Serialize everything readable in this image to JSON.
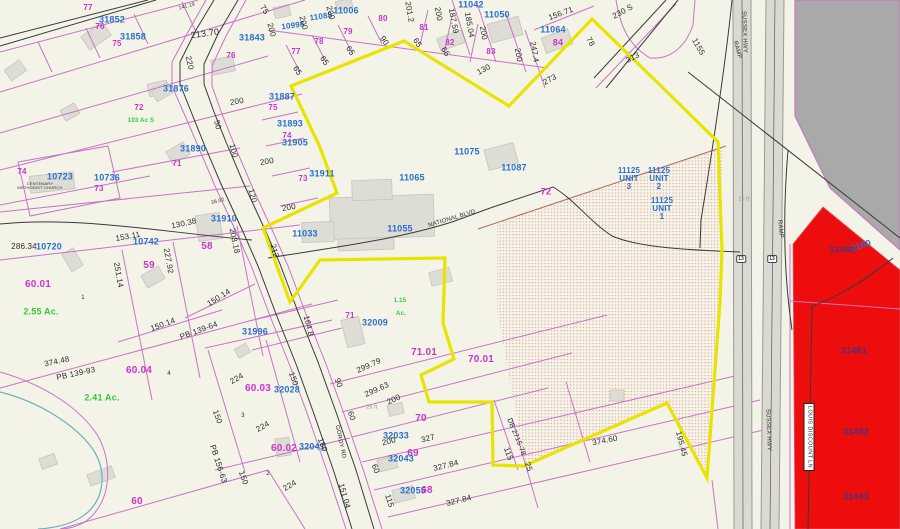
{
  "map_type": "county-tax-parcel-map",
  "colors": {
    "background": "#f4f3e8",
    "parcel_line": "#c873c8",
    "highlight_boundary": "#e8e400",
    "red_parcel": "#ee0d0d",
    "gray_area": "#a9a9a9",
    "road_fill": "#dbdad2",
    "parcel_id_text": "#2a6fcc",
    "lot_number_text": "#cc33cc",
    "acreage_text": "#2ecc3a",
    "dimension_text": "#2b2b2b",
    "stream": "#68b0ba",
    "stipple_dot": "#dd8a80"
  },
  "roads": {
    "national_blvd": "NATIONAL BLVD",
    "gordy_rd": "GORDY RD",
    "sussex_hwy": "SUSSEX HWY",
    "ramp": "RAMP",
    "louis_discount_ln": "LOUIS DISCOUNT LN",
    "road_230s": "230 S",
    "route_shield": "13"
  },
  "labels": [
    {
      "t": "77",
      "x": 88,
      "y": 8,
      "c": "m"
    },
    {
      "t": "31852",
      "x": 112,
      "y": 20,
      "c": "b",
      "s": 9
    },
    {
      "t": "76",
      "x": 100,
      "y": 27,
      "c": "m"
    },
    {
      "t": "31858",
      "x": 133,
      "y": 37,
      "c": "b",
      "s": 9
    },
    {
      "t": "75",
      "x": 117,
      "y": 44,
      "c": "m"
    },
    {
      "t": "141.19",
      "x": 187,
      "y": 7,
      "s": 5,
      "r": -15
    },
    {
      "t": "213.70",
      "x": 205,
      "y": 34,
      "r": -8,
      "s": 9
    },
    {
      "t": "31843",
      "x": 252,
      "y": 38,
      "c": "b",
      "s": 9
    },
    {
      "t": "76",
      "x": 231,
      "y": 56,
      "c": "m"
    },
    {
      "t": "220",
      "x": 189,
      "y": 63,
      "r": 78
    },
    {
      "t": "75",
      "x": 264,
      "y": 10,
      "r": 55
    },
    {
      "t": "200",
      "x": 271,
      "y": 30,
      "r": 75
    },
    {
      "t": "10998",
      "x": 293,
      "y": 26,
      "c": "b",
      "r": -8
    },
    {
      "t": "11088",
      "x": 321,
      "y": 17,
      "c": "b",
      "r": -8
    },
    {
      "t": "11006",
      "x": 346,
      "y": 11,
      "c": "b",
      "s": 9
    },
    {
      "t": "200",
      "x": 303,
      "y": 23,
      "r": 75
    },
    {
      "t": "200",
      "x": 330,
      "y": 13,
      "r": 75
    },
    {
      "t": "77",
      "x": 296,
      "y": 52,
      "c": "m"
    },
    {
      "t": "78",
      "x": 319,
      "y": 42,
      "c": "m"
    },
    {
      "t": "79",
      "x": 348,
      "y": 32,
      "c": "m"
    },
    {
      "t": "80",
      "x": 383,
      "y": 19,
      "c": "m"
    },
    {
      "t": "81",
      "x": 424,
      "y": 28,
      "c": "m"
    },
    {
      "t": "82",
      "x": 450,
      "y": 43,
      "c": "m"
    },
    {
      "t": "83",
      "x": 491,
      "y": 52,
      "c": "m"
    },
    {
      "t": "65",
      "x": 297,
      "y": 71,
      "r": 55
    },
    {
      "t": "65",
      "x": 324,
      "y": 61,
      "r": 55
    },
    {
      "t": "65",
      "x": 350,
      "y": 51,
      "r": 55
    },
    {
      "t": "90",
      "x": 384,
      "y": 41,
      "r": 55
    },
    {
      "t": "65",
      "x": 417,
      "y": 43,
      "r": 55
    },
    {
      "t": "66",
      "x": 445,
      "y": 52,
      "r": 55
    },
    {
      "t": "130",
      "x": 484,
      "y": 70,
      "r": -28
    },
    {
      "t": "201.2",
      "x": 409,
      "y": 12,
      "r": 80
    },
    {
      "t": "200",
      "x": 438,
      "y": 14,
      "r": 80
    },
    {
      "t": "187.59",
      "x": 453,
      "y": 21,
      "r": 80
    },
    {
      "t": "185.04",
      "x": 469,
      "y": 25,
      "r": 80
    },
    {
      "t": "200",
      "x": 483,
      "y": 33,
      "r": 80
    },
    {
      "t": "11042",
      "x": 471,
      "y": 5,
      "c": "b",
      "s": 9
    },
    {
      "t": "11050",
      "x": 497,
      "y": 15,
      "c": "b",
      "s": 9
    },
    {
      "t": "11064",
      "x": 553,
      "y": 30,
      "c": "b",
      "s": 9
    },
    {
      "t": "84",
      "x": 558,
      "y": 43,
      "c": "m",
      "s": 9
    },
    {
      "t": "156.71",
      "x": 561,
      "y": 14,
      "r": -20
    },
    {
      "t": "200",
      "x": 518,
      "y": 55,
      "r": 80
    },
    {
      "t": "247.4",
      "x": 534,
      "y": 52,
      "r": 80
    },
    {
      "t": "78",
      "x": 590,
      "y": 42,
      "r": 60
    },
    {
      "t": "273",
      "x": 550,
      "y": 80,
      "r": -28
    },
    {
      "t": "313",
      "x": 633,
      "y": 58,
      "r": -28
    },
    {
      "t": "230 S",
      "x": 623,
      "y": 12,
      "r": -28
    },
    {
      "t": "1155",
      "x": 698,
      "y": 47,
      "r": 60
    },
    {
      "t": "31876",
      "x": 176,
      "y": 89,
      "c": "b",
      "s": 9
    },
    {
      "t": "72",
      "x": 139,
      "y": 108,
      "c": "m"
    },
    {
      "t": "103 Ac S",
      "x": 141,
      "y": 121,
      "c": "g",
      "s": 6
    },
    {
      "t": "200",
      "x": 237,
      "y": 102,
      "r": -10
    },
    {
      "t": "31887",
      "x": 282,
      "y": 97,
      "c": "b",
      "s": 9
    },
    {
      "t": "75",
      "x": 273,
      "y": 108,
      "c": "m"
    },
    {
      "t": "50",
      "x": 217,
      "y": 125,
      "r": 75
    },
    {
      "t": "31893",
      "x": 290,
      "y": 124,
      "c": "b",
      "s": 9
    },
    {
      "t": "74",
      "x": 287,
      "y": 136,
      "c": "m"
    },
    {
      "t": "100",
      "x": 233,
      "y": 151,
      "r": 75
    },
    {
      "t": "31890",
      "x": 193,
      "y": 149,
      "c": "b",
      "s": 9
    },
    {
      "t": "71",
      "x": 177,
      "y": 164,
      "c": "m"
    },
    {
      "t": "200",
      "x": 267,
      "y": 162,
      "r": -10
    },
    {
      "t": "31905",
      "x": 295,
      "y": 143,
      "c": "b",
      "s": 9
    },
    {
      "t": "73",
      "x": 303,
      "y": 179,
      "c": "m"
    },
    {
      "t": "31911",
      "x": 322,
      "y": 174,
      "c": "b",
      "s": 9
    },
    {
      "t": "200",
      "x": 289,
      "y": 208,
      "r": -10
    },
    {
      "t": "11033",
      "x": 305,
      "y": 234,
      "c": "b",
      "s": 9
    },
    {
      "t": "212",
      "x": 274,
      "y": 251,
      "r": 75
    },
    {
      "t": "11065",
      "x": 412,
      "y": 178,
      "c": "b",
      "s": 9
    },
    {
      "t": "11075",
      "x": 467,
      "y": 152,
      "c": "b",
      "s": 9
    },
    {
      "t": "11087",
      "x": 514,
      "y": 168,
      "c": "b",
      "s": 9
    },
    {
      "t": "11055",
      "x": 400,
      "y": 229,
      "c": "b",
      "s": 9
    },
    {
      "t": "NATIONAL BLVD",
      "x": 452,
      "y": 219,
      "r": -17,
      "s": 6
    },
    {
      "t": "72",
      "x": 546,
      "y": 192,
      "c": "m",
      "s": 9
    },
    {
      "t": "11125\nUNIT\n3",
      "x": 629,
      "y": 179,
      "c": "b"
    },
    {
      "t": "11125\nUNIT\n2",
      "x": 659,
      "y": 179,
      "c": "b"
    },
    {
      "t": "11125\nUNIT\n1",
      "x": 662,
      "y": 209,
      "c": "b"
    },
    {
      "t": "25 ft",
      "x": 744,
      "y": 200,
      "c": "gr",
      "s": 5
    },
    {
      "t": "10723",
      "x": 60,
      "y": 177,
      "c": "b",
      "s": 9
    },
    {
      "t": "10736",
      "x": 107,
      "y": 178,
      "c": "b",
      "s": 9
    },
    {
      "t": "73",
      "x": 99,
      "y": 189,
      "c": "m"
    },
    {
      "t": "74",
      "x": 22,
      "y": 172,
      "c": "m"
    },
    {
      "t": "CENTENARY\nMETHODIST CHURCH",
      "x": 40,
      "y": 186,
      "s": 4
    },
    {
      "t": "120",
      "x": 252,
      "y": 196,
      "r": 75
    },
    {
      "t": "28.02",
      "x": 218,
      "y": 202,
      "s": 5,
      "r": -15
    },
    {
      "t": "130.38",
      "x": 184,
      "y": 224,
      "r": -12
    },
    {
      "t": "31910",
      "x": 224,
      "y": 219,
      "c": "b",
      "s": 9
    },
    {
      "t": "203.18",
      "x": 234,
      "y": 241,
      "r": 78
    },
    {
      "t": "153.11",
      "x": 128,
      "y": 237,
      "r": -10
    },
    {
      "t": "10742",
      "x": 146,
      "y": 242,
      "c": "b",
      "s": 9
    },
    {
      "t": "227.92",
      "x": 168,
      "y": 261,
      "r": 80
    },
    {
      "t": "58",
      "x": 207,
      "y": 247,
      "c": "m",
      "s": 10
    },
    {
      "t": "59",
      "x": 149,
      "y": 266,
      "c": "m",
      "s": 10
    },
    {
      "t": "251.14",
      "x": 118,
      "y": 275,
      "r": 80
    },
    {
      "t": "286.34",
      "x": 24,
      "y": 247
    },
    {
      "t": "10720",
      "x": 49,
      "y": 247,
      "c": "b",
      "s": 9
    },
    {
      "t": "60.01",
      "x": 38,
      "y": 285,
      "c": "m",
      "s": 10
    },
    {
      "t": "2.55 Ac.",
      "x": 41,
      "y": 312,
      "c": "g",
      "s": 9
    },
    {
      "t": "150.14",
      "x": 219,
      "y": 298,
      "r": -32
    },
    {
      "t": "1",
      "x": 83,
      "y": 298,
      "s": 6
    },
    {
      "t": "374.48",
      "x": 57,
      "y": 362,
      "r": -12
    },
    {
      "t": "PB 139-93",
      "x": 76,
      "y": 374,
      "r": -12
    },
    {
      "t": "60.04",
      "x": 139,
      "y": 371,
      "c": "m",
      "s": 10
    },
    {
      "t": "4",
      "x": 169,
      "y": 374,
      "s": 6
    },
    {
      "t": "2.41 Ac.",
      "x": 102,
      "y": 398,
      "c": "g",
      "s": 9
    },
    {
      "t": "150.14",
      "x": 163,
      "y": 325,
      "r": -20
    },
    {
      "t": "PB 139-64",
      "x": 199,
      "y": 331,
      "r": -20
    },
    {
      "t": "31996",
      "x": 255,
      "y": 332,
      "c": "b",
      "s": 9
    },
    {
      "t": "224",
      "x": 237,
      "y": 379,
      "r": -30
    },
    {
      "t": "60.03",
      "x": 258,
      "y": 389,
      "c": "m",
      "s": 10
    },
    {
      "t": "32028",
      "x": 287,
      "y": 390,
      "c": "b",
      "s": 9
    },
    {
      "t": "150",
      "x": 217,
      "y": 417,
      "r": 70
    },
    {
      "t": "3",
      "x": 243,
      "y": 416,
      "s": 6
    },
    {
      "t": "224",
      "x": 263,
      "y": 427,
      "r": -30
    },
    {
      "t": "PB 156-63",
      "x": 218,
      "y": 464,
      "r": 72
    },
    {
      "t": "150",
      "x": 243,
      "y": 478,
      "r": 70
    },
    {
      "t": "2",
      "x": 268,
      "y": 474,
      "s": 6
    },
    {
      "t": "60",
      "x": 137,
      "y": 502,
      "c": "m",
      "s": 10
    },
    {
      "t": "60.02",
      "x": 284,
      "y": 449,
      "c": "m",
      "s": 10
    },
    {
      "t": "32041",
      "x": 312,
      "y": 447,
      "c": "b",
      "s": 9
    },
    {
      "t": "150",
      "x": 322,
      "y": 445,
      "r": 70
    },
    {
      "t": "224",
      "x": 290,
      "y": 486,
      "r": -30
    },
    {
      "t": "151.04",
      "x": 344,
      "y": 496,
      "r": 74
    },
    {
      "t": "GORDY RD",
      "x": 340,
      "y": 442,
      "r": 78,
      "s": 6
    },
    {
      "t": "164.8",
      "x": 308,
      "y": 326,
      "r": 76
    },
    {
      "t": "150",
      "x": 293,
      "y": 379,
      "r": 70
    },
    {
      "t": "32009",
      "x": 375,
      "y": 323,
      "c": "b",
      "s": 9
    },
    {
      "t": "71",
      "x": 350,
      "y": 316,
      "c": "m"
    },
    {
      "t": "71.01",
      "x": 424,
      "y": 353,
      "c": "m",
      "s": 10
    },
    {
      "t": "70.01",
      "x": 481,
      "y": 360,
      "c": "m",
      "s": 10
    },
    {
      "t": "299.79",
      "x": 369,
      "y": 366,
      "r": -24
    },
    {
      "t": "90",
      "x": 338,
      "y": 383,
      "r": 70
    },
    {
      "t": "299.63",
      "x": 377,
      "y": 390,
      "r": -24
    },
    {
      "t": "200",
      "x": 394,
      "y": 400,
      "r": -24
    },
    {
      "t": "26 ft",
      "x": 372,
      "y": 408,
      "c": "gr",
      "s": 5
    },
    {
      "t": "60",
      "x": 351,
      "y": 416,
      "r": 70
    },
    {
      "t": "70",
      "x": 421,
      "y": 419,
      "c": "m",
      "s": 10
    },
    {
      "t": "32033",
      "x": 396,
      "y": 436,
      "c": "b",
      "s": 9
    },
    {
      "t": "200",
      "x": 389,
      "y": 442,
      "r": -14
    },
    {
      "t": "327",
      "x": 428,
      "y": 439,
      "r": -14
    },
    {
      "t": "69",
      "x": 413,
      "y": 454,
      "c": "m",
      "s": 10
    },
    {
      "t": "32043",
      "x": 401,
      "y": 459,
      "c": "b",
      "s": 9
    },
    {
      "t": "60",
      "x": 375,
      "y": 469,
      "r": 70
    },
    {
      "t": "327.84",
      "x": 446,
      "y": 466,
      "r": -14
    },
    {
      "t": "115",
      "x": 508,
      "y": 454,
      "r": 70
    },
    {
      "t": "DB 2715-78",
      "x": 516,
      "y": 437,
      "r": 68,
      "s": 7
    },
    {
      "t": "25",
      "x": 528,
      "y": 467,
      "r": 70
    },
    {
      "t": "32055",
      "x": 413,
      "y": 491,
      "c": "b",
      "s": 9
    },
    {
      "t": "68",
      "x": 427,
      "y": 491,
      "c": "m",
      "s": 10
    },
    {
      "t": "327.84",
      "x": 459,
      "y": 501,
      "r": -14
    },
    {
      "t": "115",
      "x": 389,
      "y": 501,
      "r": 72
    },
    {
      "t": "1.15",
      "x": 400,
      "y": 301,
      "c": "g",
      "s": 6
    },
    {
      "t": "Ac.",
      "x": 401,
      "y": 314,
      "c": "g",
      "s": 6
    },
    {
      "t": "374.60",
      "x": 605,
      "y": 441,
      "r": -11
    },
    {
      "t": "195.45",
      "x": 681,
      "y": 444,
      "r": 75
    },
    {
      "t": "SUSSEX HWY",
      "x": 744,
      "y": 32,
      "r": 88,
      "s": 6
    },
    {
      "t": "SUSSEX HWY",
      "x": 768,
      "y": 430,
      "r": 88,
      "s": 6
    },
    {
      "t": "RAMP",
      "x": 737,
      "y": 50,
      "r": 75,
      "s": 6
    },
    {
      "t": "RAMP",
      "x": 780,
      "y": 229,
      "r": 85,
      "s": 6
    },
    {
      "t": "2160",
      "x": 861,
      "y": 246,
      "c": "b",
      "r": -18,
      "s": 9
    },
    {
      "t": "31460",
      "x": 842,
      "y": 250,
      "c": "n",
      "s": 9
    },
    {
      "t": "31461",
      "x": 854,
      "y": 351,
      "c": "n",
      "s": 9
    },
    {
      "t": "31462",
      "x": 856,
      "y": 432,
      "c": "n",
      "s": 9
    },
    {
      "t": "31463",
      "x": 856,
      "y": 497,
      "c": "n",
      "s": 9
    }
  ],
  "shields": [
    {
      "t": "13",
      "x": 741,
      "y": 259
    },
    {
      "t": "13",
      "x": 772,
      "y": 259
    }
  ],
  "road_name_boxes": [
    {
      "t": "LOUIS DISCOUNT LN",
      "x": 809,
      "y": 437,
      "r": 90
    }
  ]
}
